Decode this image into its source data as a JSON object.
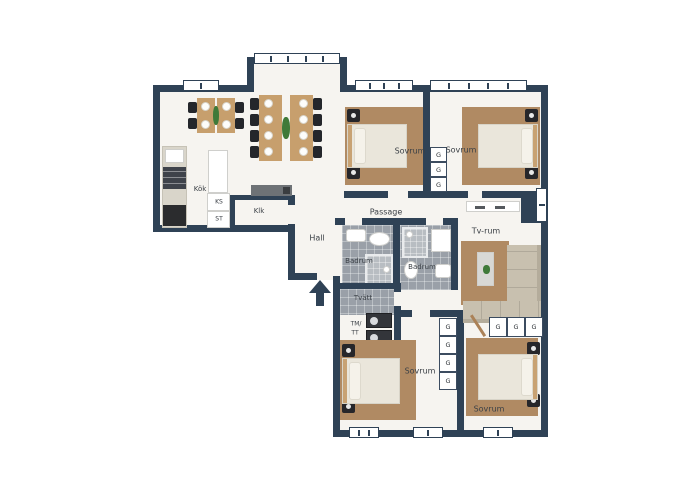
{
  "plan_type": "apartment-floor-plan",
  "rooms": [
    {
      "id": "kok",
      "label": "Kök"
    },
    {
      "id": "klk",
      "label": "Klk"
    },
    {
      "id": "sovrum-top-middle",
      "label": "Sovrum"
    },
    {
      "id": "sovrum-top-right",
      "label": "Sovrum"
    },
    {
      "id": "passage",
      "label": "Passage"
    },
    {
      "id": "hall",
      "label": "Hall"
    },
    {
      "id": "badrum-left",
      "label": "Badrum"
    },
    {
      "id": "badrum-right",
      "label": "Badrum"
    },
    {
      "id": "tvatt",
      "label": "Tvätt"
    },
    {
      "id": "tv-rum",
      "label": "Tv-rum"
    },
    {
      "id": "sovrum-bottom-middle",
      "label": "Sovrum"
    },
    {
      "id": "sovrum-bottom-right",
      "label": "Sovrum"
    }
  ],
  "fixtures": {
    "ks": "KS",
    "st": "ST",
    "tm": "TM/",
    "tt": "TT",
    "wardrobe": "G"
  },
  "colors": {
    "wall": "#2f4256",
    "floor": "#f6f4f0",
    "tile": "#9aa0a8",
    "rug": "#b08a63",
    "bed": "#eae6db",
    "wood": "#c79f6d",
    "sofa": "#c8c0af",
    "plant": "#3f7a39",
    "label_text": "#3b4046"
  }
}
